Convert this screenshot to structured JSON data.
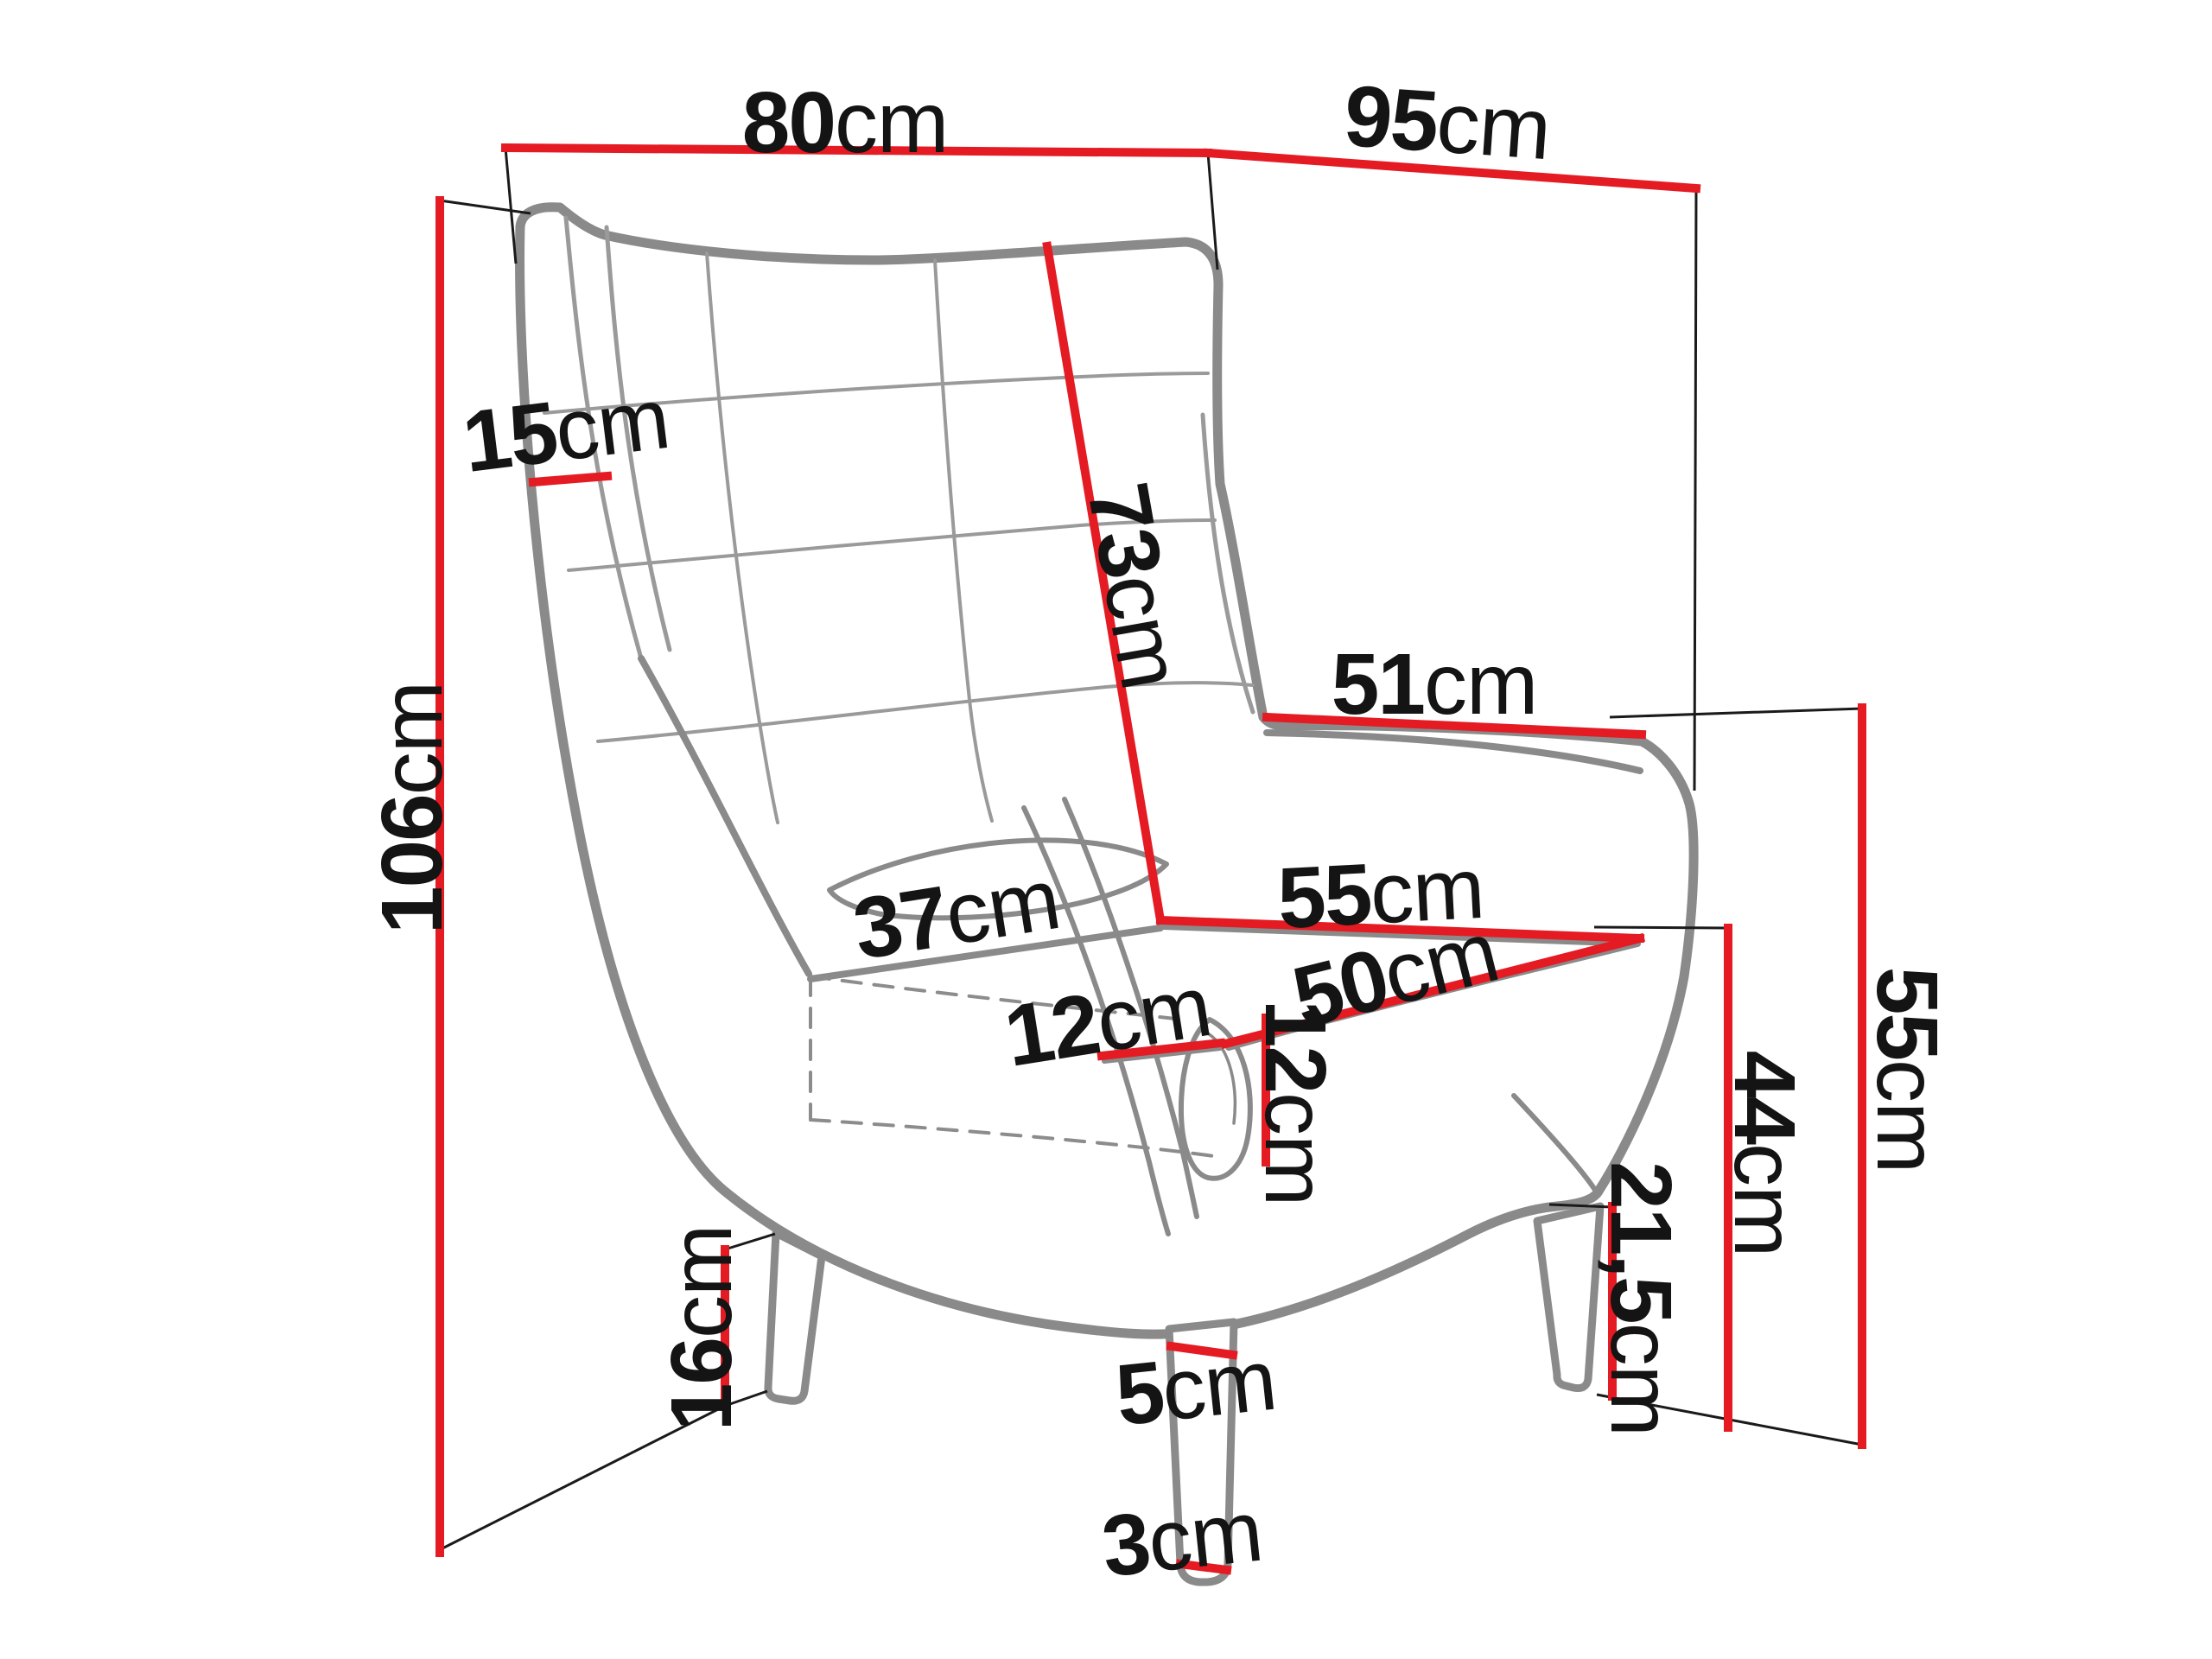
{
  "diagram": {
    "subject": "wingback armchair dimensions",
    "unit": "cm",
    "colors": {
      "dimension_line_red": "#e41b23",
      "chair_outline_gray": "#8a8a8a",
      "seam_gray": "#9a9a9a",
      "extension_line_black": "#1a1a1a",
      "label_text": "#141414",
      "background": "#ffffff"
    },
    "dimensions": {
      "back_width_top": {
        "value": "80",
        "unit": "cm"
      },
      "total_depth": {
        "value": "95",
        "unit": "cm"
      },
      "total_height": {
        "value": "106",
        "unit": "cm"
      },
      "wing_thickness": {
        "value": "15",
        "unit": "cm"
      },
      "backrest_height": {
        "value": "73",
        "unit": "cm"
      },
      "backrest_width_low": {
        "value": "51",
        "unit": "cm"
      },
      "seat_width": {
        "value": "55",
        "unit": "cm"
      },
      "seat_depth": {
        "value": "50",
        "unit": "cm"
      },
      "armrest_length": {
        "value": "37",
        "unit": "cm"
      },
      "armrest_width": {
        "value": "12",
        "unit": "cm"
      },
      "armrest_front_height": {
        "value": "12",
        "unit": "cm"
      },
      "side_height": {
        "value": "55",
        "unit": "cm"
      },
      "seat_height": {
        "value": "44",
        "unit": "cm"
      },
      "under_seat_clearance": {
        "value": "21,5",
        "unit": "cm"
      },
      "rear_leg_height": {
        "value": "16",
        "unit": "cm"
      },
      "front_leg_top_width": {
        "value": "5",
        "unit": "cm"
      },
      "front_leg_tip_width": {
        "value": "3",
        "unit": "cm"
      }
    }
  }
}
